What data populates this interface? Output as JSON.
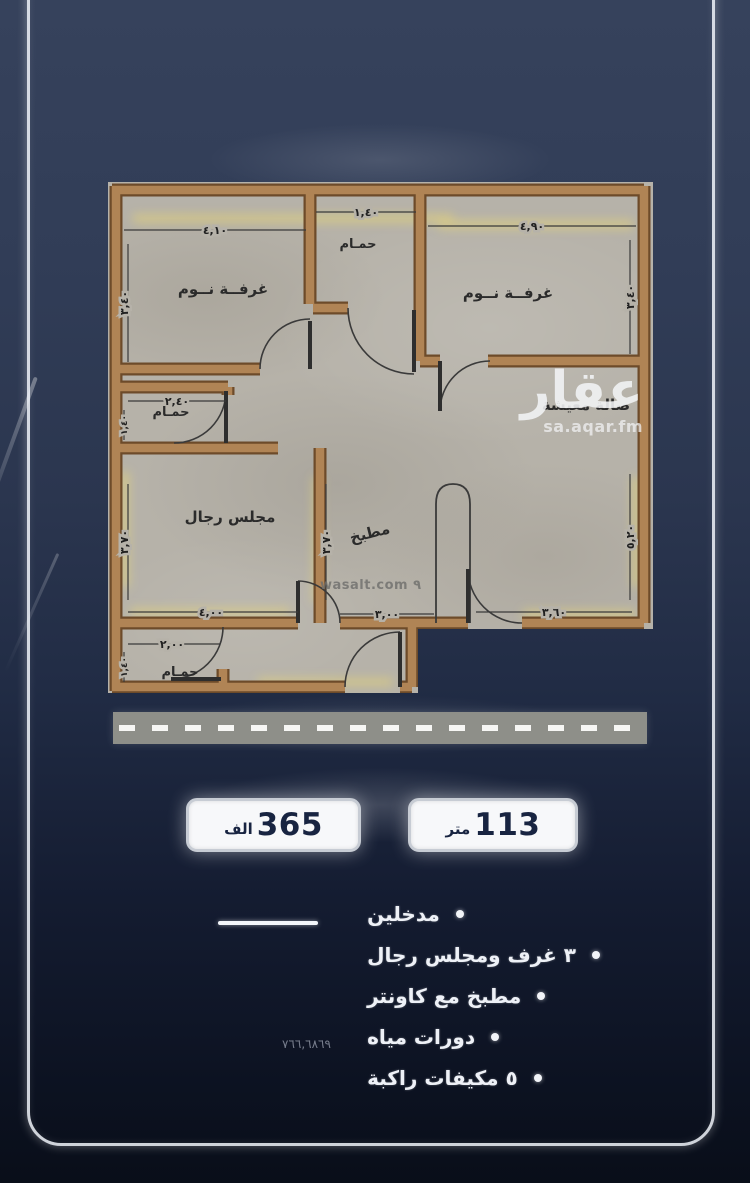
{
  "watermarks": {
    "brand": "عقار",
    "brand_url": "sa.aqar.fm",
    "wasalt": "wasalt.com ٩"
  },
  "badges": {
    "price": {
      "value": "365",
      "unit": "الف"
    },
    "area": {
      "value": "113",
      "unit": "متر"
    }
  },
  "features": {
    "items": [
      "مدخلين",
      "٣ غرف ومجلس رجال",
      "مطبخ مع كاونتر",
      "دورات مياه",
      "٥ مكيفات راكبة"
    ]
  },
  "ref_number": "٧٦٦,٦٨٦٩",
  "plan": {
    "rooms": {
      "bedroom_left": "غرفــة نــوم",
      "bedroom_right": "غرفــة نــوم",
      "bath_top": "حمـام",
      "bath_mid": "حمـام",
      "bath_bottom": "حمـام",
      "majlis": "مجلس رجال",
      "kitchen": "مطبخ",
      "living": "صالة معيشة"
    },
    "dims": {
      "top_left": "٤,١٠",
      "top_mid": "١,٤٠",
      "top_right": "٤,٩٠",
      "left_v": "٣,٤٠",
      "right_v": "٣,٤٠",
      "bath_mid_w": "٢,٤٠",
      "bath_mid_h": "١,٤٠",
      "majlis_v": "٣,٧٠",
      "kitchen_v": "٣,٧٠",
      "living_v": "٥,٢٠",
      "majlis_w": "٤,٠٠",
      "kitchen_w": "٣,٠٠",
      "living_w": "٣,٦٠",
      "bath_bottom_w": "٢,٠٠",
      "bath_bottom_h": "١,٤٠"
    }
  }
}
